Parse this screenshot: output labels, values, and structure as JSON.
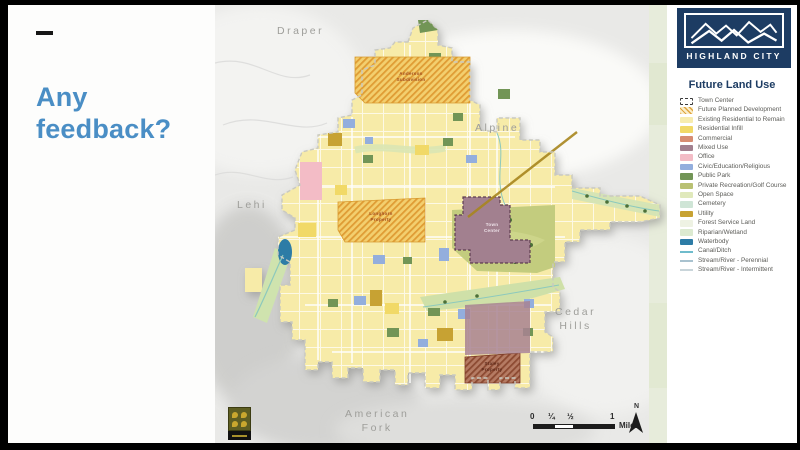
{
  "slide": {
    "dash": "—",
    "heading_line1": "Any",
    "heading_line2": "feedback?"
  },
  "map": {
    "neighbor_labels": [
      {
        "text": "Draper",
        "x": 62,
        "y": 20
      },
      {
        "text": "Alpine",
        "x": 260,
        "y": 117
      },
      {
        "text": "Lehi",
        "x": 22,
        "y": 194
      },
      {
        "text": "Cedar\nHills",
        "x": 340,
        "y": 301
      },
      {
        "text": "American\nFork",
        "x": 130,
        "y": 403
      }
    ],
    "area_labels": [
      {
        "text": "Anderson\nSubdivision",
        "x": 170,
        "y": 66,
        "color": "#a14c20"
      },
      {
        "text": "Longhorn\nProperty",
        "x": 140,
        "y": 206,
        "color": "#a14c20"
      },
      {
        "text": "Town\nCenter",
        "x": 251,
        "y": 217,
        "color": "#efe3ea"
      },
      {
        "text": "Staley\nProperty",
        "x": 251,
        "y": 356,
        "color": "#5e2a1a"
      }
    ],
    "scale": {
      "ticks": [
        "0",
        "¼",
        "½",
        "1"
      ],
      "unit": "Miles"
    },
    "north": "N"
  },
  "legend_panel": {
    "logo_title": "HIGHLAND CITY",
    "title": "Future Land Use",
    "items": [
      {
        "label": "Town Center",
        "swatch": "dashed",
        "color": "#ffffff",
        "border": "#3a3a3a"
      },
      {
        "label": "Future Planned Development",
        "swatch": "hatch",
        "color": "#dfa43f",
        "color2": "#faeeca"
      },
      {
        "label": "Existing Residential to Remain",
        "swatch": "fill",
        "color": "#f7ecae"
      },
      {
        "label": "Residential Infill",
        "swatch": "fill",
        "color": "#f1d967"
      },
      {
        "label": "Commercial",
        "swatch": "fill",
        "color": "#d78d72"
      },
      {
        "label": "Mixed Use",
        "swatch": "fill",
        "color": "#a2808f"
      },
      {
        "label": "Office",
        "swatch": "fill",
        "color": "#f3bcc6"
      },
      {
        "label": "Civic/Education/Religious",
        "swatch": "fill",
        "color": "#93aedd"
      },
      {
        "label": "Public Park",
        "swatch": "fill",
        "color": "#729556"
      },
      {
        "label": "Private Recreation/Golf Course",
        "swatch": "fill",
        "color": "#b9c173"
      },
      {
        "label": "Open Space",
        "swatch": "fill",
        "color": "#e0e9bb"
      },
      {
        "label": "Cemetery",
        "swatch": "fill",
        "color": "#cfe5d6"
      },
      {
        "label": "Utility",
        "swatch": "fill",
        "color": "#c7a233"
      },
      {
        "label": "Forest Service Land",
        "swatch": "fill",
        "color": "#eef2e3"
      },
      {
        "label": "Riparian/Wetland",
        "swatch": "fill",
        "color": "#dcead0"
      },
      {
        "label": "Waterbody",
        "swatch": "fill",
        "color": "#2d7ca6"
      },
      {
        "label": "Canal/Ditch",
        "swatch": "line",
        "color": "#6fbccc"
      },
      {
        "label": "Stream/River - Perennial",
        "swatch": "line",
        "color": "#a9c2cf"
      },
      {
        "label": "Stream/River - Intermittent",
        "swatch": "line",
        "color": "#c9d5da"
      }
    ]
  },
  "colors": {
    "accent_blue": "#4a8ec5",
    "navy": "#1d3c63",
    "city_yellow": "#f7eba8",
    "map_background": "#e9e9e7"
  }
}
